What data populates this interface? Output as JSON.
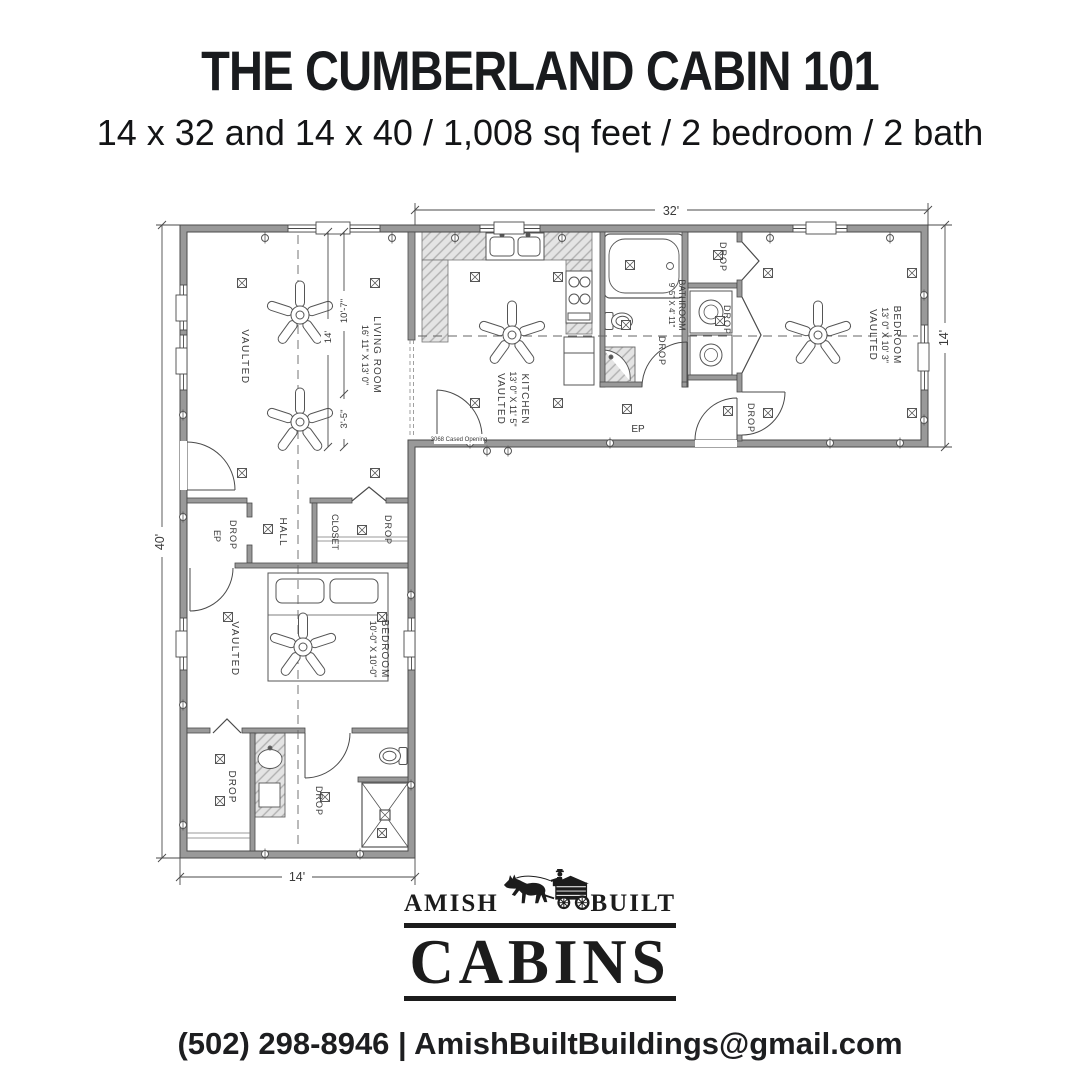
{
  "header": {
    "title": "THE CUMBERLAND CABIN 101",
    "subtitle": "14 x 32 and 14 x 40 / 1,008 sq feet / 2 bedroom / 2 bath"
  },
  "plan": {
    "dims": {
      "top": "32'",
      "right": "14'",
      "left": "40'",
      "bottom": "14'",
      "inner_total": "14'",
      "inner_upper": "10'-7\"",
      "inner_lower": "3'-5\""
    },
    "rooms": {
      "living": {
        "name": "LIVING ROOM",
        "size": "16' 11\" X 13' 0\"",
        "note": "VAULTED"
      },
      "kitchen": {
        "name": "KITCHEN",
        "size": "13' 0\" X 11' 5\"",
        "note": "VAULTED"
      },
      "bath1": {
        "name": "BATHROOM",
        "size": "9' 5\" X 4' 11\""
      },
      "bed1": {
        "name": "BEDROOM",
        "size": "13' 0\" X 10' 3\"",
        "note": "VAULTED"
      },
      "bed2": {
        "name": "BEDROOM",
        "size": "10'-0\" X 10'-0\"",
        "note": "VAULTED"
      },
      "hall": {
        "name": "HALL"
      },
      "closet": {
        "name": "CLOSET"
      }
    },
    "labels": {
      "drop": "DROP",
      "ep": "EP",
      "cased": "3068 Cased Opening"
    }
  },
  "logo": {
    "left": "AMISH",
    "right": "BUILT",
    "main": "CABINS"
  },
  "footer": {
    "contact": "(502) 298-8946 | AmishBuiltBuildings@gmail.com"
  }
}
